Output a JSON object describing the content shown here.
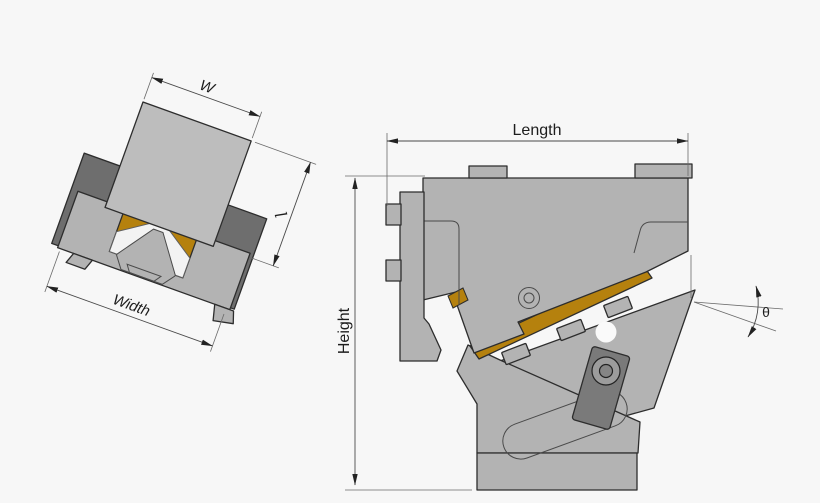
{
  "drawing": {
    "labels": {
      "w": "W",
      "l": "l",
      "width": "Width",
      "length": "Length",
      "height": "Height",
      "theta": "θ"
    },
    "colors": {
      "background": "#f7f7f7",
      "body_gray": "#b3b3b3",
      "tray_gray": "#bdbdbd",
      "plate_dark_gray": "#6e6e6e",
      "armature_gray": "#7a7a7a",
      "spring_orange": "#b5810e",
      "fastener_gray": "#9c9c9c",
      "cutout_white": "#f3f3f3",
      "hole_white": "#fafafa",
      "outline": "#2d2d2d",
      "dimension_line": "#4a4a4a"
    }
  }
}
